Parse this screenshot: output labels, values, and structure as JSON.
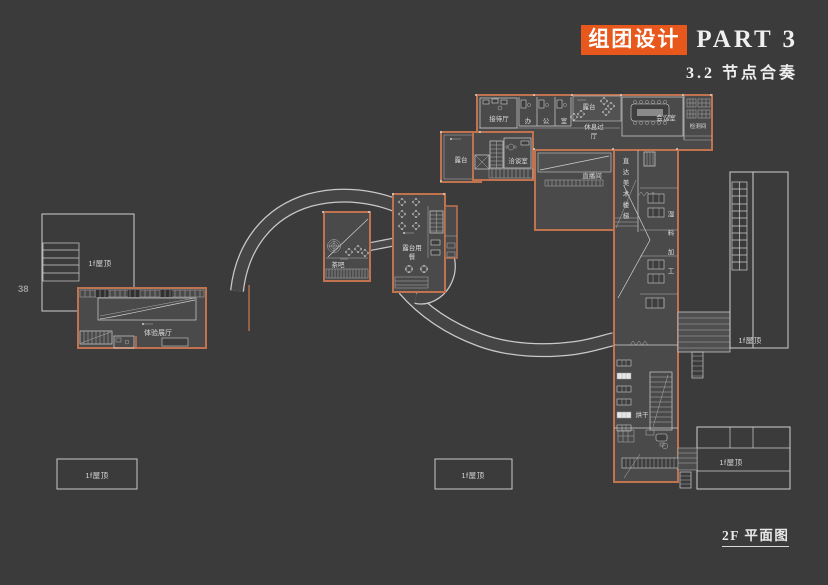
{
  "colors": {
    "background": "#3b3b3b",
    "accent_orange": "#e8581c",
    "wall_orange": "#c1724f",
    "floor_gray": "#4a4a4a",
    "line_white": "#d0d0d0"
  },
  "page_number": "38",
  "header": {
    "title_box": "组团设计",
    "title_part": "PART 3",
    "subtitle": "3.2 节点合奏"
  },
  "footer": {
    "caption": "2F 平面图"
  },
  "plan": {
    "labels": {
      "reception": "接待厅",
      "terrace": "露台",
      "rest_hall_1": "休息过",
      "rest_hall_2": "厅",
      "meeting": "会议室",
      "testing": "检测间",
      "negotiation": "洽谈室",
      "studio": "直播间",
      "drying": "烘干",
      "tea_bar": "茶吧",
      "dining_1": "露台用",
      "dining_2": "餐",
      "exhibition": "体验展厅",
      "roof": "1f屋顶"
    },
    "office_chars": [
      "办",
      "公",
      "室"
    ],
    "art_stair_chars": [
      "直",
      "达",
      "美",
      "术",
      "楼",
      "梯"
    ],
    "wet_chars": [
      "湿",
      "料",
      "加",
      "工"
    ]
  }
}
